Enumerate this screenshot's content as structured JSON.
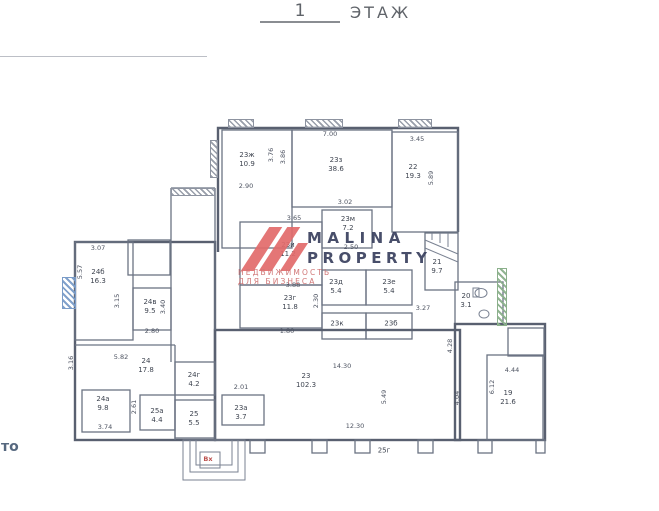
{
  "title": {
    "number": "1",
    "word": "ЭТАЖ"
  },
  "side_fragment": "то",
  "entrance": {
    "label": "Вх"
  },
  "watermark": {
    "brand_line1": "MALINA",
    "brand_line2": "PROPERTY",
    "tagline": "НЕДВИЖИМОСТЬ ДЛЯ БИЗНЕСА",
    "logo_color": "#e26b6b",
    "brand_color": "#39405e",
    "tagline_color": "#cd6b6b"
  },
  "colors": {
    "wall": "#6b7383",
    "outer_wall": "#596070",
    "label_text": "#3e4450",
    "hatch_blue": "#7a9cc8",
    "hatch_green": "#8bb08b",
    "entrance_red": "#bb4f4c"
  },
  "rooms": [
    {
      "name": "23ж",
      "area": "10.9",
      "x": 247,
      "y": 160
    },
    {
      "name": "23з",
      "area": "38.6",
      "x": 336,
      "y": 165
    },
    {
      "name": "22",
      "area": "19.3",
      "x": 413,
      "y": 172
    },
    {
      "name": "23м",
      "area": "7.2",
      "x": 348,
      "y": 224
    },
    {
      "name": "23и",
      "area": "11.2",
      "x": 288,
      "y": 250
    },
    {
      "name": "23г",
      "area": "11.8",
      "x": 290,
      "y": 303
    },
    {
      "name": "23д",
      "area": "5.4",
      "x": 336,
      "y": 287
    },
    {
      "name": "23е",
      "area": "5.4",
      "x": 389,
      "y": 287
    },
    {
      "name": "23к",
      "area": "",
      "x": 337,
      "y": 324
    },
    {
      "name": "23б",
      "area": "",
      "x": 391,
      "y": 324
    },
    {
      "name": "21",
      "area": "9.7",
      "x": 437,
      "y": 267
    },
    {
      "name": "20",
      "area": "3.1",
      "x": 466,
      "y": 301
    },
    {
      "name": "19",
      "area": "21.6",
      "x": 508,
      "y": 398
    },
    {
      "name": "23",
      "area": "102.3",
      "x": 306,
      "y": 381
    },
    {
      "name": "24б",
      "area": "16.3",
      "x": 98,
      "y": 277
    },
    {
      "name": "24в",
      "area": "9.5",
      "x": 150,
      "y": 307
    },
    {
      "name": "24",
      "area": "17.8",
      "x": 146,
      "y": 366
    },
    {
      "name": "24а",
      "area": "9.8",
      "x": 103,
      "y": 404
    },
    {
      "name": "24г",
      "area": "4.2",
      "x": 194,
      "y": 380
    },
    {
      "name": "25а",
      "area": "4.4",
      "x": 157,
      "y": 416
    },
    {
      "name": "25",
      "area": "5.5",
      "x": 194,
      "y": 419
    },
    {
      "name": "23а",
      "area": "3.7",
      "x": 241,
      "y": 413
    },
    {
      "name": "25г",
      "area": "",
      "x": 384,
      "y": 451
    }
  ],
  "dimensions": [
    {
      "text": "7.00",
      "x": 330,
      "y": 134,
      "v": false
    },
    {
      "text": "3.45",
      "x": 417,
      "y": 139,
      "v": false
    },
    {
      "text": "2.90",
      "x": 246,
      "y": 186,
      "v": false
    },
    {
      "text": "3.02",
      "x": 345,
      "y": 202,
      "v": false
    },
    {
      "text": "3.65",
      "x": 294,
      "y": 218,
      "v": false
    },
    {
      "text": "2.50",
      "x": 351,
      "y": 247,
      "v": false
    },
    {
      "text": "3.88",
      "x": 293,
      "y": 285,
      "v": false
    },
    {
      "text": "1.80",
      "x": 287,
      "y": 331,
      "v": false
    },
    {
      "text": "3.07",
      "x": 98,
      "y": 248,
      "v": false
    },
    {
      "text": "2.80",
      "x": 152,
      "y": 331,
      "v": false
    },
    {
      "text": "5.82",
      "x": 121,
      "y": 357,
      "v": false
    },
    {
      "text": "3.74",
      "x": 105,
      "y": 427,
      "v": false
    },
    {
      "text": "2.01",
      "x": 241,
      "y": 387,
      "v": false
    },
    {
      "text": "3.27",
      "x": 423,
      "y": 308,
      "v": false
    },
    {
      "text": "14.30",
      "x": 342,
      "y": 366,
      "v": false
    },
    {
      "text": "12.30",
      "x": 355,
      "y": 426,
      "v": false
    },
    {
      "text": "4.44",
      "x": 512,
      "y": 370,
      "v": false
    },
    {
      "text": "3.76",
      "x": 271,
      "y": 155,
      "v": true
    },
    {
      "text": "3.86",
      "x": 283,
      "y": 157,
      "v": true
    },
    {
      "text": "5.89",
      "x": 431,
      "y": 178,
      "v": true
    },
    {
      "text": "2.30",
      "x": 316,
      "y": 301,
      "v": true
    },
    {
      "text": "5.57",
      "x": 80,
      "y": 272,
      "v": true
    },
    {
      "text": "3.15",
      "x": 117,
      "y": 301,
      "v": true
    },
    {
      "text": "3.40",
      "x": 163,
      "y": 307,
      "v": true
    },
    {
      "text": "3.16",
      "x": 71,
      "y": 363,
      "v": true
    },
    {
      "text": "2.61",
      "x": 134,
      "y": 407,
      "v": true
    },
    {
      "text": "5.49",
      "x": 384,
      "y": 397,
      "v": true
    },
    {
      "text": "4.28",
      "x": 450,
      "y": 346,
      "v": true
    },
    {
      "text": "4.04",
      "x": 457,
      "y": 398,
      "v": true
    },
    {
      "text": "6.12",
      "x": 492,
      "y": 387,
      "v": true
    }
  ]
}
